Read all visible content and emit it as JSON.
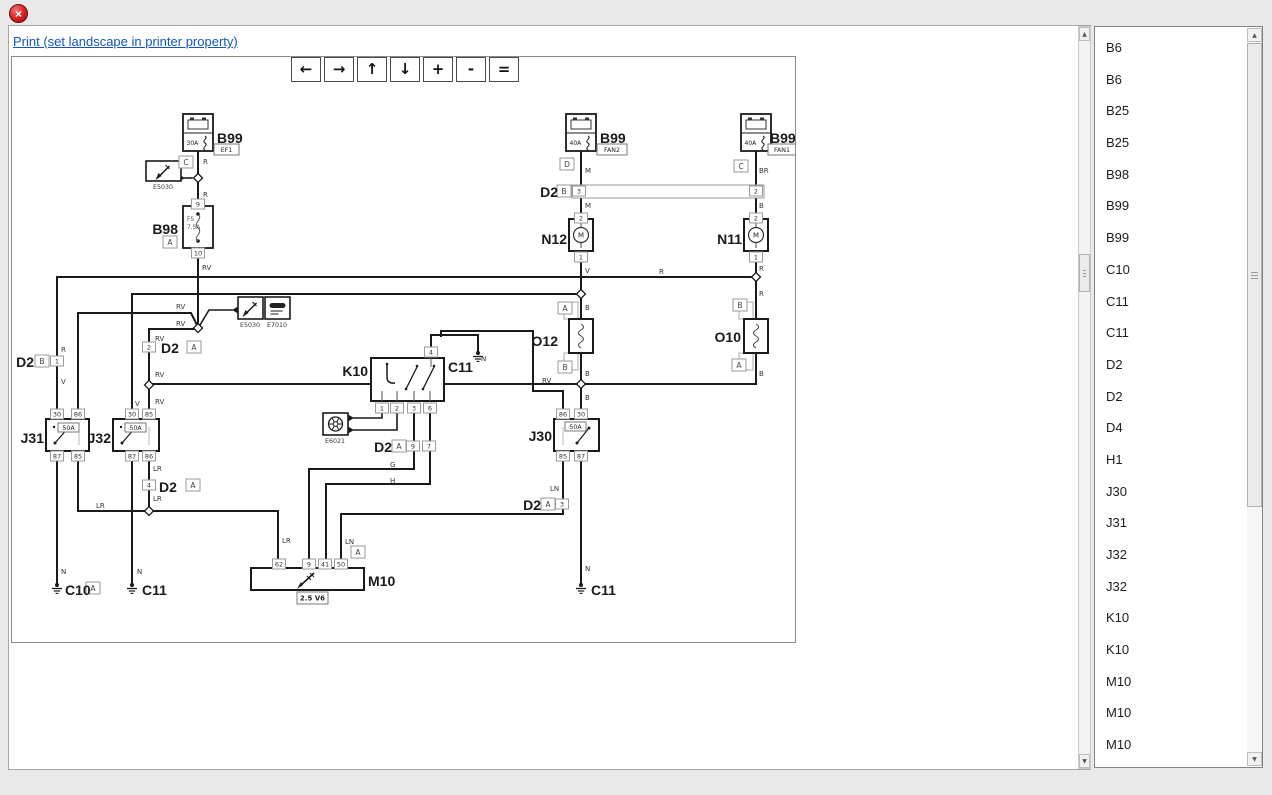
{
  "window": {
    "close_glyph": "×"
  },
  "print_link": {
    "label": "Print (set landscape in printer property)"
  },
  "toolbar": {
    "buttons": [
      {
        "id": "pan-left-button",
        "glyph": "←"
      },
      {
        "id": "pan-right-button",
        "glyph": "→"
      },
      {
        "id": "pan-up-button",
        "glyph": "↑"
      },
      {
        "id": "pan-down-button",
        "glyph": "↓"
      },
      {
        "id": "zoom-in-button",
        "glyph": "+"
      },
      {
        "id": "zoom-out-button",
        "glyph": "-"
      },
      {
        "id": "zoom-fit-button",
        "glyph": "="
      }
    ]
  },
  "sidebar": {
    "items": [
      "B6",
      "B6",
      "B25",
      "B25",
      "B98",
      "B99",
      "B99",
      "C10",
      "C11",
      "C11",
      "D2",
      "D2",
      "D4",
      "H1",
      "J30",
      "J31",
      "J32",
      "J32",
      "K10",
      "K10",
      "M10",
      "M10",
      "M10"
    ]
  },
  "scrollbars": {
    "up_glyph": "▲",
    "down_glyph": "▼"
  },
  "diagram": {
    "stroke": "#1a1a1a",
    "wires": [
      {
        "p": [
          [
            197,
            150
          ],
          [
            197,
            327
          ]
        ]
      },
      {
        "p": [
          [
            56,
            276
          ],
          [
            755,
            276
          ]
        ]
      },
      {
        "p": [
          [
            56,
            276
          ],
          [
            56,
            585
          ]
        ]
      },
      {
        "p": [
          [
            580,
            150
          ],
          [
            580,
            418
          ]
        ]
      },
      {
        "p": [
          [
            755,
            150
          ],
          [
            755,
            383
          ]
        ]
      },
      {
        "p": [
          [
            131,
            293
          ],
          [
            580,
            293
          ]
        ]
      },
      {
        "p": [
          [
            131,
            293
          ],
          [
            131,
            585
          ]
        ]
      },
      {
        "p": [
          [
            77,
            413
          ],
          [
            77,
            312
          ],
          [
            190,
            312
          ],
          [
            197,
            326
          ]
        ]
      },
      {
        "p": [
          [
            197,
            328
          ],
          [
            148,
            328
          ],
          [
            148,
            413
          ]
        ]
      },
      {
        "p": [
          [
            148,
            383
          ],
          [
            755,
            383
          ]
        ]
      },
      {
        "p": [
          [
            562,
            413
          ],
          [
            562,
            390
          ],
          [
            532,
            390
          ],
          [
            532,
            330
          ],
          [
            440,
            330
          ],
          [
            440,
            335
          ]
        ]
      },
      {
        "p": [
          [
            430,
            346
          ],
          [
            430,
            334
          ],
          [
            477,
            334
          ],
          [
            477,
            352
          ]
        ]
      },
      {
        "p": [
          [
            413,
            412
          ],
          [
            413,
            468
          ],
          [
            308,
            468
          ],
          [
            308,
            563
          ]
        ]
      },
      {
        "p": [
          [
            429,
            412
          ],
          [
            429,
            483
          ],
          [
            325,
            483
          ],
          [
            325,
            563
          ]
        ]
      },
      {
        "p": [
          [
            77,
            455
          ],
          [
            77,
            510
          ],
          [
            277,
            510
          ],
          [
            277,
            563
          ]
        ]
      },
      {
        "p": [
          [
            148,
            455
          ],
          [
            148,
            510
          ]
        ]
      },
      {
        "p": [
          [
            562,
            455
          ],
          [
            562,
            513
          ],
          [
            340,
            513
          ],
          [
            340,
            563
          ]
        ]
      },
      {
        "p": [
          [
            580,
            450
          ],
          [
            580,
            585
          ]
        ]
      }
    ],
    "arrows": [
      {
        "p": [
          [
            191,
            177
          ],
          [
            184,
            177
          ]
        ],
        "dir": "left"
      },
      {
        "p": [
          [
            199,
            324
          ],
          [
            208,
            309
          ],
          [
            231,
            309
          ]
        ],
        "dir": "right"
      },
      {
        "p": [
          [
            381,
            412
          ],
          [
            381,
            417
          ],
          [
            353,
            417
          ]
        ],
        "dir": "left"
      },
      {
        "p": [
          [
            396,
            412
          ],
          [
            396,
            429
          ],
          [
            353,
            429
          ]
        ],
        "dir": "left"
      }
    ],
    "bar": {
      "x": 571,
      "y": 184,
      "w": 192,
      "h": 13
    },
    "components": [
      {
        "type": "battery",
        "x": 182,
        "y": 113,
        "amp": "30A"
      },
      {
        "type": "battery",
        "x": 565,
        "y": 113,
        "amp": "40A"
      },
      {
        "type": "battery",
        "x": 740,
        "y": 113,
        "amp": "40A"
      },
      {
        "type": "fuse",
        "x": 182,
        "y": 205,
        "f": "F5",
        "amp": "7.5A"
      },
      {
        "type": "motor",
        "x": 568,
        "y": 218,
        "m": "M"
      },
      {
        "type": "motor",
        "x": 743,
        "y": 218,
        "m": "M"
      },
      {
        "type": "resistor",
        "x": 568,
        "y": 318
      },
      {
        "type": "resistor",
        "x": 743,
        "y": 318
      },
      {
        "type": "relay",
        "x": 45,
        "y": 418,
        "w": 43
      },
      {
        "type": "relay",
        "x": 112,
        "y": 418,
        "w": 46
      },
      {
        "type": "relay",
        "x": 553,
        "y": 418,
        "w": 45,
        "flip": true
      },
      {
        "type": "k10",
        "x": 370,
        "y": 357
      },
      {
        "type": "ecu",
        "x": 250,
        "y": 567
      },
      {
        "type": "eicon",
        "x": 145,
        "y": 160,
        "w": 35,
        "h": 20,
        "icon": "injector"
      },
      {
        "type": "eicon",
        "x": 237,
        "y": 296,
        "w": 25,
        "h": 22,
        "icon": "injector"
      },
      {
        "type": "eicon",
        "x": 264,
        "y": 296,
        "w": 25,
        "h": 22,
        "icon": "plug"
      },
      {
        "type": "eicon",
        "x": 322,
        "y": 412,
        "w": 25,
        "h": 22,
        "icon": "wheel"
      }
    ],
    "junctions": [
      [
        197,
        177
      ],
      [
        197,
        327
      ],
      [
        755,
        276
      ],
      [
        580,
        293
      ],
      [
        148,
        384
      ],
      [
        580,
        383
      ],
      [
        148,
        510
      ]
    ],
    "grounds": [
      [
        56,
        585
      ],
      [
        131,
        585
      ],
      [
        580,
        585
      ],
      [
        477,
        353
      ]
    ],
    "pin_boxes": [
      {
        "x": 197,
        "y": 203,
        "t": "9"
      },
      {
        "x": 197,
        "y": 252,
        "t": "10"
      },
      {
        "x": 56,
        "y": 360,
        "t": "1"
      },
      {
        "x": 578,
        "y": 190,
        "t": "3"
      },
      {
        "x": 755,
        "y": 190,
        "t": "2"
      },
      {
        "x": 580,
        "y": 217,
        "t": "2"
      },
      {
        "x": 580,
        "y": 256,
        "t": "1"
      },
      {
        "x": 755,
        "y": 217,
        "t": "2"
      },
      {
        "x": 755,
        "y": 256,
        "t": "1"
      },
      {
        "x": 148,
        "y": 346,
        "t": "2"
      },
      {
        "x": 148,
        "y": 484,
        "t": "4"
      },
      {
        "x": 561,
        "y": 503,
        "t": "3"
      },
      {
        "x": 56,
        "y": 413,
        "t": "30"
      },
      {
        "x": 77,
        "y": 413,
        "t": "86"
      },
      {
        "x": 56,
        "y": 455,
        "t": "87"
      },
      {
        "x": 77,
        "y": 455,
        "t": "85"
      },
      {
        "x": 131,
        "y": 413,
        "t": "30"
      },
      {
        "x": 148,
        "y": 413,
        "t": "85"
      },
      {
        "x": 131,
        "y": 455,
        "t": "87"
      },
      {
        "x": 148,
        "y": 455,
        "t": "86"
      },
      {
        "x": 562,
        "y": 413,
        "t": "86"
      },
      {
        "x": 580,
        "y": 413,
        "t": "30"
      },
      {
        "x": 562,
        "y": 455,
        "t": "85"
      },
      {
        "x": 580,
        "y": 455,
        "t": "87"
      },
      {
        "x": 430,
        "y": 351,
        "t": "4"
      },
      {
        "x": 381,
        "y": 407,
        "t": "1"
      },
      {
        "x": 396,
        "y": 407,
        "t": "2"
      },
      {
        "x": 413,
        "y": 407,
        "t": "3"
      },
      {
        "x": 429,
        "y": 407,
        "t": "6"
      },
      {
        "x": 412,
        "y": 445,
        "t": "9"
      },
      {
        "x": 428,
        "y": 445,
        "t": "7"
      },
      {
        "x": 278,
        "y": 563,
        "t": "62"
      },
      {
        "x": 308,
        "y": 563,
        "t": "9"
      },
      {
        "x": 324,
        "y": 563,
        "t": "41"
      },
      {
        "x": 340,
        "y": 563,
        "t": "50"
      }
    ],
    "letter_boxes": [
      {
        "x": 185,
        "y": 161,
        "t": "C"
      },
      {
        "x": 169,
        "y": 241,
        "t": "A"
      },
      {
        "x": 566,
        "y": 163,
        "t": "D"
      },
      {
        "x": 740,
        "y": 165,
        "t": "C"
      },
      {
        "x": 563,
        "y": 190,
        "t": "B"
      },
      {
        "x": 41,
        "y": 360,
        "t": "B"
      },
      {
        "x": 193,
        "y": 346,
        "t": "A"
      },
      {
        "x": 192,
        "y": 484,
        "t": "A"
      },
      {
        "x": 398,
        "y": 445,
        "t": "A"
      },
      {
        "x": 547,
        "y": 503,
        "t": "A"
      },
      {
        "x": 564,
        "y": 307,
        "t": "A"
      },
      {
        "x": 564,
        "y": 366,
        "t": "B"
      },
      {
        "x": 739,
        "y": 304,
        "t": "B"
      },
      {
        "x": 738,
        "y": 364,
        "t": "A"
      },
      {
        "x": 92,
        "y": 587,
        "t": "A"
      },
      {
        "x": 357,
        "y": 551,
        "t": "A"
      }
    ],
    "tag_boxes": [
      {
        "x": 213,
        "y": 143,
        "w": 25,
        "h": 11,
        "t": "EF1"
      },
      {
        "x": 596,
        "y": 143,
        "w": 30,
        "h": 11,
        "t": "FAN2"
      },
      {
        "x": 767,
        "y": 143,
        "w": 28,
        "h": 11,
        "t": "FAN1"
      },
      {
        "x": 57,
        "y": 422,
        "w": 21,
        "h": 9,
        "t": "50A"
      },
      {
        "x": 124,
        "y": 422,
        "w": 21,
        "h": 9,
        "t": "50A"
      },
      {
        "x": 564,
        "y": 421,
        "w": 21,
        "h": 9,
        "t": "50A"
      },
      {
        "x": 296,
        "y": 591,
        "w": 31,
        "h": 12,
        "t": "2.5 V6",
        "bold": true
      }
    ],
    "bold_labels": [
      {
        "t": "B99",
        "x": 216,
        "y": 142,
        "a": "s"
      },
      {
        "t": "B98",
        "x": 177,
        "y": 233,
        "a": "e"
      },
      {
        "t": "B99",
        "x": 599,
        "y": 142,
        "a": "s"
      },
      {
        "t": "B99",
        "x": 769,
        "y": 142,
        "a": "s"
      },
      {
        "t": "D2",
        "x": 557,
        "y": 196,
        "a": "e"
      },
      {
        "t": "N12",
        "x": 566,
        "y": 243,
        "a": "e"
      },
      {
        "t": "N11",
        "x": 741,
        "y": 243,
        "a": "e"
      },
      {
        "t": "O12",
        "x": 557,
        "y": 345,
        "a": "e"
      },
      {
        "t": "O10",
        "x": 740,
        "y": 341,
        "a": "e"
      },
      {
        "t": "D2",
        "x": 33,
        "y": 366,
        "a": "e"
      },
      {
        "t": "D2",
        "x": 160,
        "y": 352,
        "a": "s"
      },
      {
        "t": "J31",
        "x": 43,
        "y": 442,
        "a": "e"
      },
      {
        "t": "J32",
        "x": 110,
        "y": 442,
        "a": "e"
      },
      {
        "t": "J30",
        "x": 551,
        "y": 440,
        "a": "e"
      },
      {
        "t": "K10",
        "x": 367,
        "y": 375,
        "a": "e"
      },
      {
        "t": "C11",
        "x": 447,
        "y": 371,
        "a": "s"
      },
      {
        "t": "D2",
        "x": 391,
        "y": 451,
        "a": "e"
      },
      {
        "t": "D2",
        "x": 158,
        "y": 491,
        "a": "s"
      },
      {
        "t": "D2",
        "x": 540,
        "y": 509,
        "a": "e"
      },
      {
        "t": "M10",
        "x": 367,
        "y": 585,
        "a": "s"
      },
      {
        "t": "C10",
        "x": 64,
        "y": 594,
        "a": "s"
      },
      {
        "t": "C11",
        "x": 141,
        "y": 594,
        "a": "s"
      },
      {
        "t": "C11",
        "x": 590,
        "y": 594,
        "a": "s"
      }
    ],
    "wire_labels": [
      {
        "t": "R",
        "x": 202,
        "y": 163
      },
      {
        "t": "R",
        "x": 202,
        "y": 196
      },
      {
        "t": "RV",
        "x": 201,
        "y": 269
      },
      {
        "t": "M",
        "x": 584,
        "y": 172
      },
      {
        "t": "M",
        "x": 584,
        "y": 207
      },
      {
        "t": "BR",
        "x": 758,
        "y": 172
      },
      {
        "t": "B",
        "x": 758,
        "y": 207
      },
      {
        "t": "V",
        "x": 584,
        "y": 272
      },
      {
        "t": "R",
        "x": 658,
        "y": 273
      },
      {
        "t": "R",
        "x": 758,
        "y": 270
      },
      {
        "t": "R",
        "x": 758,
        "y": 295
      },
      {
        "t": "B",
        "x": 584,
        "y": 309
      },
      {
        "t": "B",
        "x": 584,
        "y": 375
      },
      {
        "t": "B",
        "x": 584,
        "y": 399
      },
      {
        "t": "B",
        "x": 758,
        "y": 375
      },
      {
        "t": "RV",
        "x": 175,
        "y": 308
      },
      {
        "t": "RV",
        "x": 175,
        "y": 325
      },
      {
        "t": "RV",
        "x": 154,
        "y": 340
      },
      {
        "t": "RV",
        "x": 154,
        "y": 376
      },
      {
        "t": "RV",
        "x": 154,
        "y": 403
      },
      {
        "t": "R",
        "x": 60,
        "y": 351
      },
      {
        "t": "V",
        "x": 60,
        "y": 383
      },
      {
        "t": "V",
        "x": 134,
        "y": 405
      },
      {
        "t": "RV",
        "x": 541,
        "y": 382
      },
      {
        "t": "N",
        "x": 480,
        "y": 360
      },
      {
        "t": "G",
        "x": 389,
        "y": 466
      },
      {
        "t": "H",
        "x": 389,
        "y": 482
      },
      {
        "t": "LR",
        "x": 152,
        "y": 470
      },
      {
        "t": "LR",
        "x": 152,
        "y": 500
      },
      {
        "t": "LR",
        "x": 95,
        "y": 507
      },
      {
        "t": "LR",
        "x": 281,
        "y": 542
      },
      {
        "t": "LN",
        "x": 549,
        "y": 490
      },
      {
        "t": "LN",
        "x": 344,
        "y": 543
      },
      {
        "t": "N",
        "x": 60,
        "y": 573
      },
      {
        "t": "N",
        "x": 136,
        "y": 573
      },
      {
        "t": "N",
        "x": 584,
        "y": 570
      }
    ],
    "tiny_labels": [
      {
        "t": "E5030",
        "x": 162,
        "y": 188
      },
      {
        "t": "E5030",
        "x": 249,
        "y": 326
      },
      {
        "t": "E7010",
        "x": 276,
        "y": 326
      },
      {
        "t": "E6021",
        "x": 334,
        "y": 442
      }
    ]
  }
}
